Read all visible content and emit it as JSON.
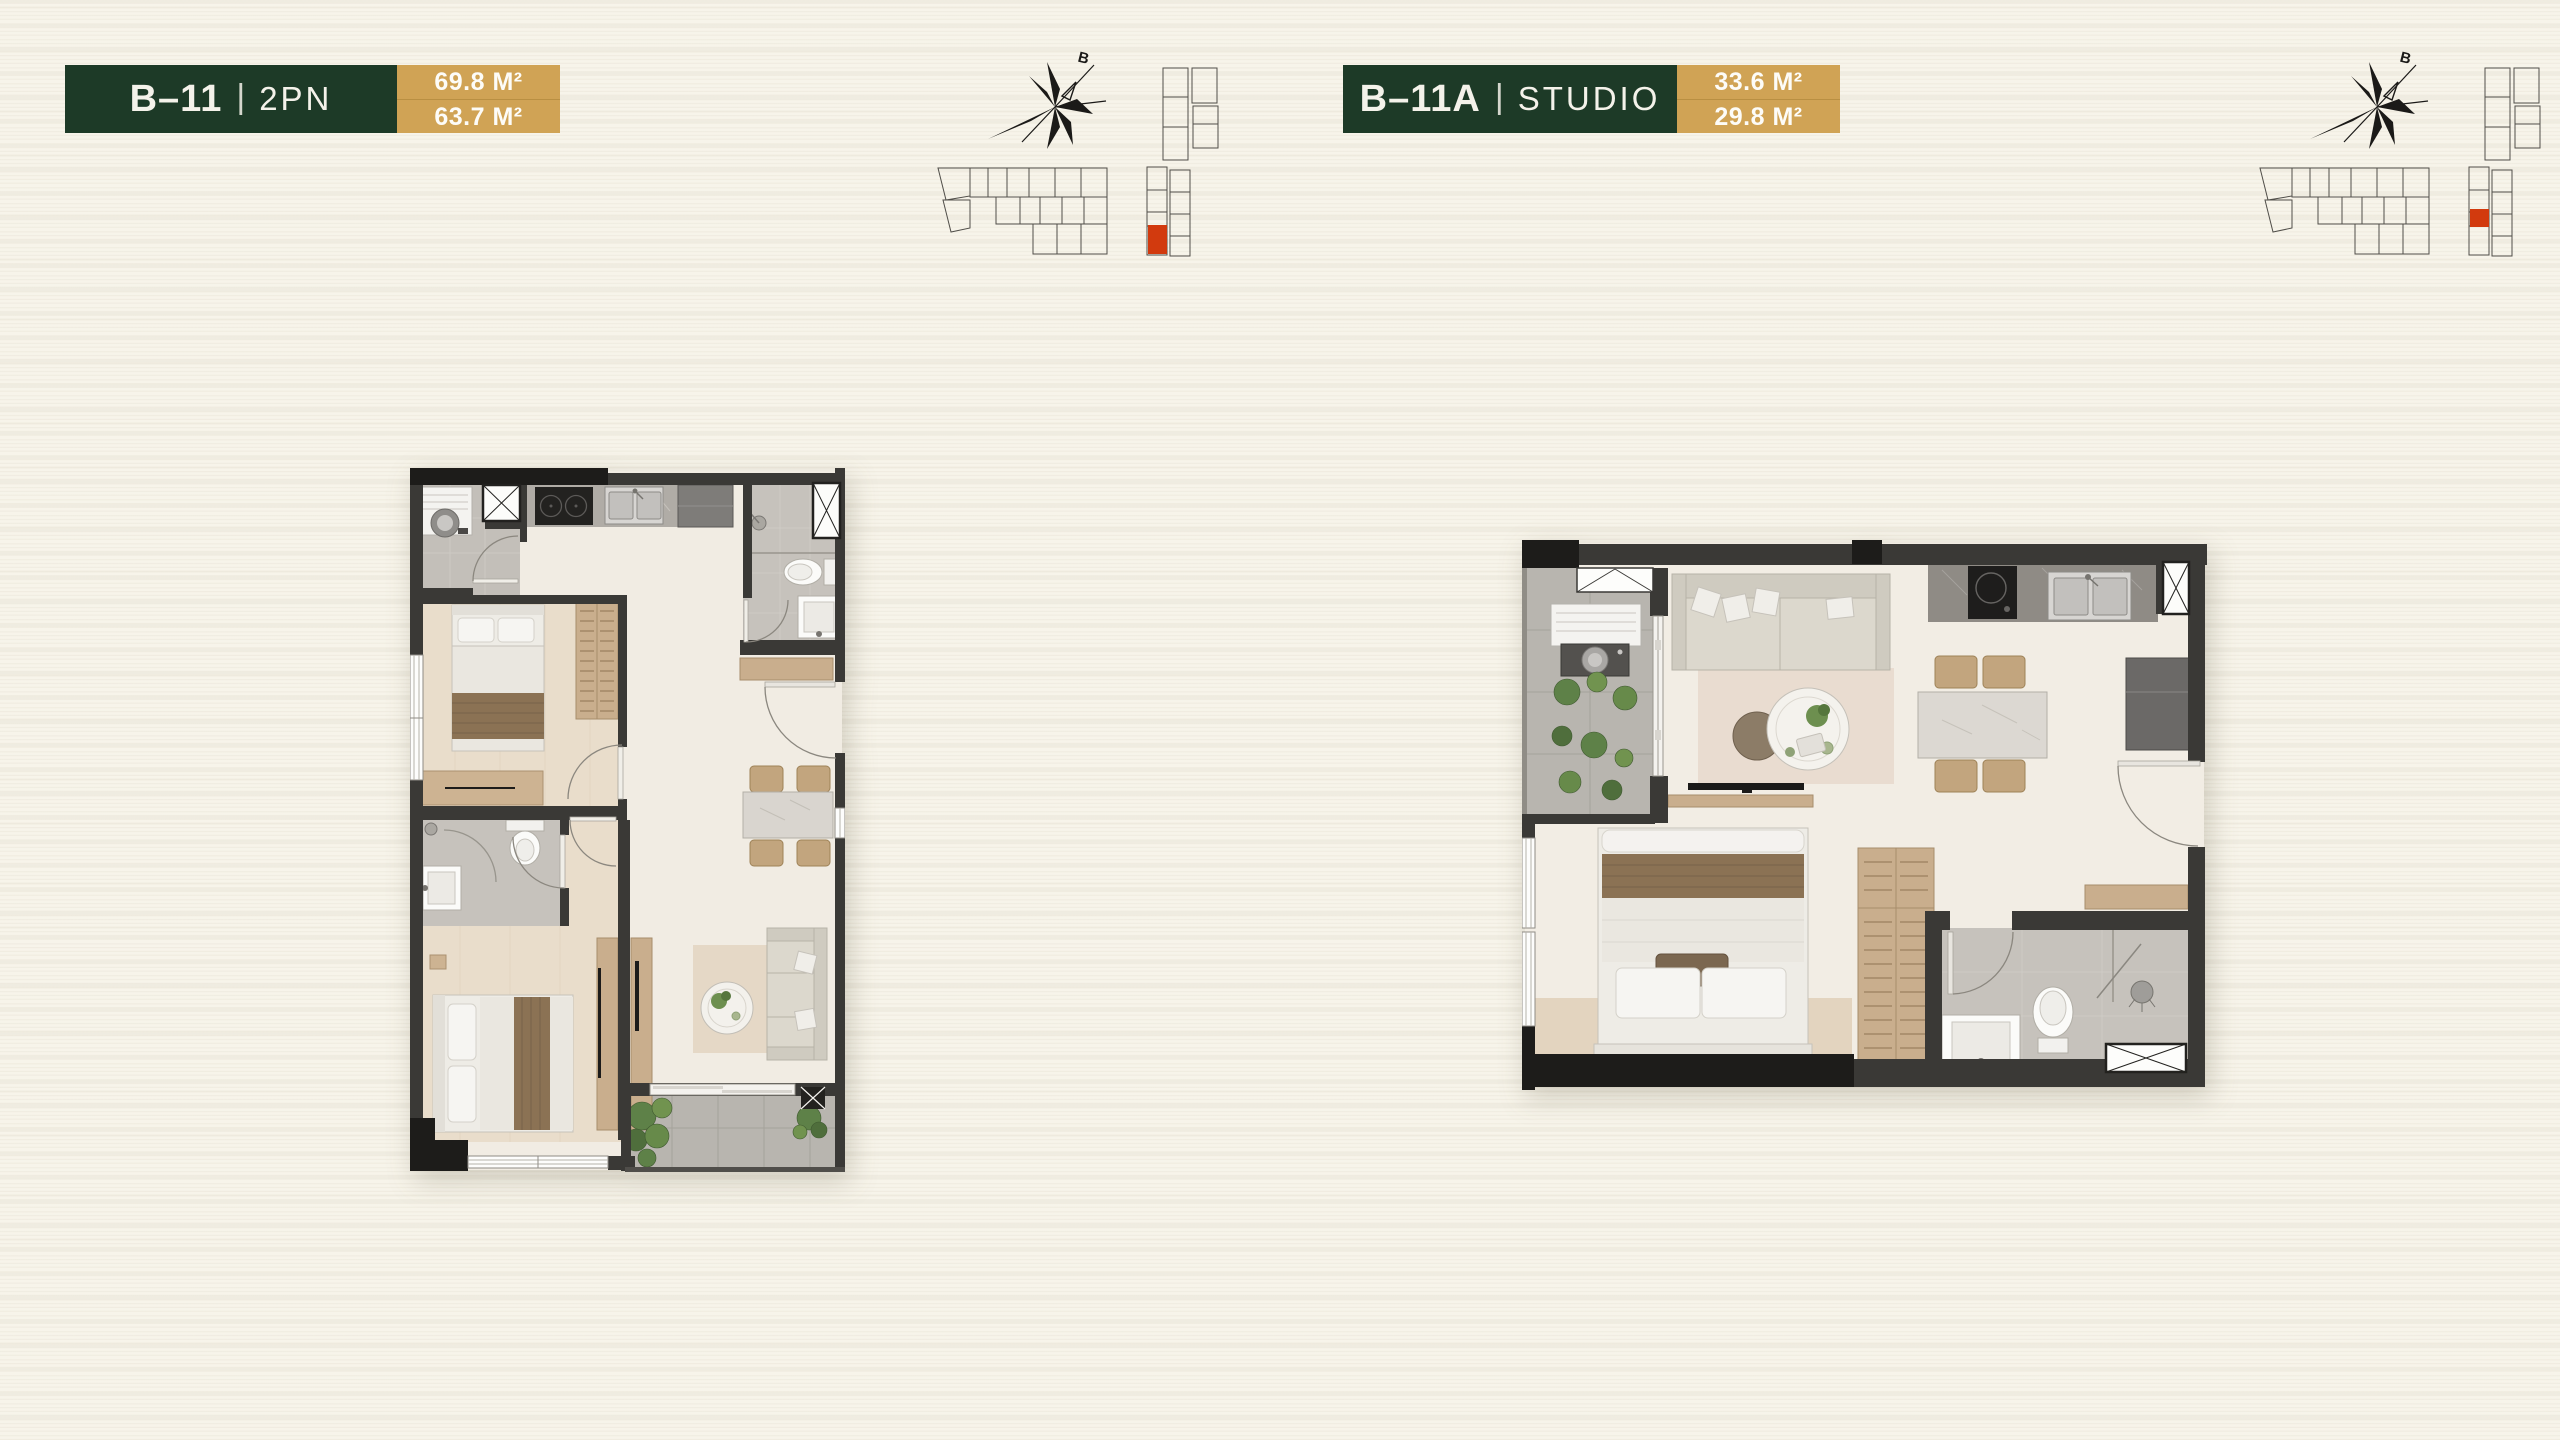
{
  "panels": [
    {
      "code": "B–11",
      "separator": "|",
      "type": "2PN",
      "area_top": "69.8 M²",
      "area_bottom": "63.7 M²",
      "compass_label": "B",
      "keyplan_highlight": {
        "x": 218,
        "y": 185,
        "width": 19,
        "height": 29
      }
    },
    {
      "code": "B–11A",
      "separator": "|",
      "type": "STUDIO",
      "area_top": "33.6 M²",
      "area_bottom": "29.8 M²",
      "compass_label": "B",
      "keyplan_highlight": {
        "x": 218,
        "y": 169,
        "width": 19,
        "height": 18
      }
    }
  ],
  "colors": {
    "page-bg": "#f7f4ea",
    "header-green": "#1d3a27",
    "header-gold": "#d0a355",
    "gold-divider": "#b98f42",
    "highlight-red": "#d23a0e"
  }
}
